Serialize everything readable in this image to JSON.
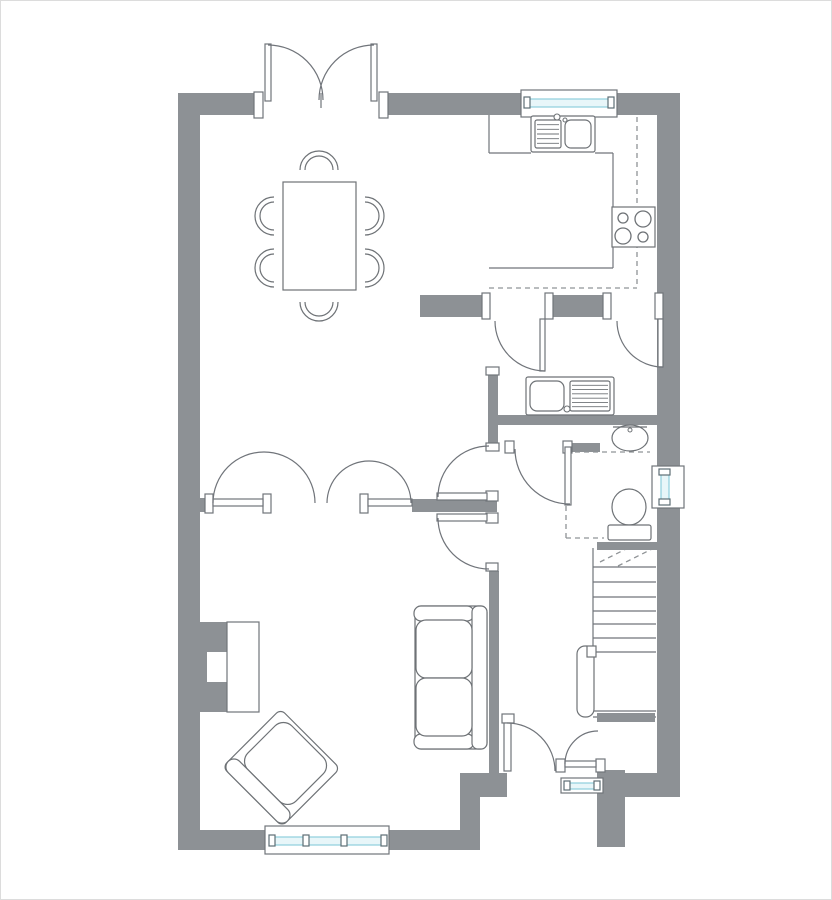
{
  "canvas": {
    "width": 832,
    "height": 900,
    "background": "#ffffff",
    "frame_color": "#dcdcdc"
  },
  "palette": {
    "wall": "#8d9195",
    "line": "#70747a",
    "furniture_line": "#6e7276",
    "dash": "#8f9396",
    "glass_stroke": "#8ecfdd",
    "glass_fill": "#e8f6f9",
    "tick": "#5d6d74",
    "white": "#ffffff"
  },
  "plan": {
    "walls": [
      [
        178,
        93,
        84,
        22
      ],
      [
        388,
        93,
        137,
        22
      ],
      [
        613,
        93,
        67,
        22
      ],
      [
        178,
        93,
        22,
        757
      ],
      [
        178,
        830,
        90,
        20
      ],
      [
        387,
        830,
        93,
        20
      ],
      [
        657,
        115,
        23,
        351
      ],
      [
        657,
        508,
        23,
        289
      ],
      [
        420,
        295,
        62,
        22
      ],
      [
        553,
        295,
        50,
        22
      ],
      [
        663,
        295,
        17,
        22
      ],
      [
        488,
        375,
        10,
        68
      ],
      [
        498,
        415,
        159,
        10
      ],
      [
        572,
        443,
        28,
        9
      ],
      [
        597,
        542,
        60,
        8
      ],
      [
        597,
        713,
        58,
        9
      ],
      [
        597,
        770,
        28,
        77
      ],
      [
        625,
        773,
        55,
        24
      ],
      [
        460,
        773,
        47,
        24
      ],
      [
        460,
        797,
        20,
        33
      ],
      [
        489,
        571,
        10,
        202
      ],
      [
        200,
        498,
        6,
        14
      ],
      [
        412,
        499,
        85,
        13
      ],
      [
        200,
        622,
        28,
        90
      ]
    ],
    "door_frames": [
      [
        254,
        92,
        9,
        26
      ],
      [
        379,
        92,
        9,
        26
      ],
      [
        482,
        293,
        8,
        26
      ],
      [
        545,
        293,
        8,
        26
      ],
      [
        603,
        293,
        8,
        26
      ],
      [
        655,
        293,
        8,
        26
      ],
      [
        486,
        367,
        13,
        8
      ],
      [
        486,
        443,
        13,
        8
      ],
      [
        486,
        491,
        12,
        10
      ],
      [
        486,
        513,
        12,
        10
      ],
      [
        486,
        563,
        12,
        8
      ],
      [
        505,
        441,
        9,
        12
      ],
      [
        563,
        441,
        9,
        12
      ],
      [
        502,
        714,
        12,
        9
      ],
      [
        556,
        759,
        9,
        13
      ],
      [
        596,
        759,
        9,
        13
      ],
      [
        205,
        494,
        8,
        19
      ],
      [
        263,
        494,
        8,
        19
      ],
      [
        360,
        494,
        8,
        19
      ]
    ],
    "door_leaves": [
      [
        265,
        44,
        6,
        57
      ],
      [
        371,
        44,
        6,
        57
      ],
      [
        213,
        499,
        50,
        7
      ],
      [
        368,
        499,
        44,
        7
      ],
      [
        437,
        493,
        50,
        7
      ],
      [
        437,
        514,
        50,
        7
      ],
      [
        540,
        319,
        5,
        52
      ],
      [
        658,
        319,
        5,
        48
      ],
      [
        565,
        447,
        6,
        58
      ],
      [
        504,
        723,
        7,
        48
      ],
      [
        565,
        761,
        31,
        6
      ]
    ],
    "door_arcs": [
      [
        268,
        100,
        55,
        270,
        360
      ],
      [
        374,
        100,
        55,
        180,
        270
      ],
      [
        264,
        503,
        51,
        180,
        360
      ],
      [
        369,
        503,
        42,
        180,
        360
      ],
      [
        489,
        497,
        51,
        180,
        270
      ],
      [
        489,
        518,
        51,
        90,
        180
      ],
      [
        545,
        321,
        50,
        90,
        180
      ],
      [
        663,
        321,
        46,
        90,
        180
      ],
      [
        570,
        449,
        55,
        90,
        180
      ],
      [
        507,
        771,
        48,
        270,
        360
      ],
      [
        598,
        764,
        33,
        180,
        270
      ]
    ],
    "windows": [
      {
        "box": [
          521,
          90,
          96,
          27
        ],
        "glass": [
          527,
          99,
          84,
          8
        ],
        "ticks": [
          [
            524,
            97,
            6,
            11
          ],
          [
            608,
            97,
            6,
            11
          ]
        ]
      },
      {
        "box": [
          265,
          826,
          124,
          28
        ],
        "glass": [
          271,
          837,
          112,
          8
        ],
        "ticks": [
          [
            269,
            835,
            6,
            11
          ],
          [
            303,
            835,
            6,
            11
          ],
          [
            341,
            835,
            6,
            11
          ],
          [
            381,
            835,
            6,
            11
          ]
        ]
      },
      {
        "box": [
          652,
          466,
          32,
          42
        ],
        "glass": [
          661,
          472,
          8,
          30
        ],
        "ticks": [
          [
            659,
            469,
            11,
            6
          ],
          [
            659,
            499,
            11,
            6
          ]
        ]
      },
      {
        "box": [
          561,
          778,
          42,
          15
        ],
        "glass": [
          567,
          783,
          30,
          6
        ],
        "ticks": [
          [
            564,
            781,
            6,
            9
          ],
          [
            594,
            781,
            6,
            9
          ]
        ]
      }
    ],
    "counter_lines": [
      [
        489,
        115,
        489,
        153
      ],
      [
        489,
        153,
        531,
        153
      ],
      [
        595,
        153,
        613,
        153
      ],
      [
        613,
        153,
        613,
        207
      ],
      [
        613,
        247,
        613,
        268
      ],
      [
        489,
        268,
        613,
        268
      ],
      [
        321,
        93,
        321,
        108
      ]
    ],
    "dashed_lines": [
      [
        637,
        117,
        637,
        288
      ],
      [
        489,
        288,
        637,
        288
      ],
      [
        566,
        452,
        650,
        452
      ],
      [
        566,
        452,
        566,
        538
      ],
      [
        566,
        538,
        604,
        538
      ],
      [
        600,
        562,
        632,
        546
      ],
      [
        618,
        566,
        652,
        549
      ]
    ],
    "stairs": {
      "side_edge": [
        593,
        548,
        593,
        712
      ],
      "tread_x": [
        593,
        656
      ],
      "tread_y": [
        567,
        582,
        597,
        611,
        624,
        638,
        652
      ],
      "bottom_lines": [
        [
          593,
          711,
          656,
          711
        ],
        [
          593,
          717,
          656,
          717
        ]
      ],
      "handrail": [
        577,
        646,
        17,
        71
      ],
      "newel": [
        587,
        646,
        9,
        11
      ]
    },
    "fireplace": {
      "hearth": [
        227,
        622,
        32,
        90
      ],
      "notch": [
        207,
        652,
        22,
        30
      ]
    },
    "kitchen_sink": {
      "unit": [
        531,
        116,
        64,
        36
      ],
      "drainer": [
        535,
        120,
        26,
        28
      ],
      "bowl": [
        565,
        120,
        26,
        28
      ],
      "tap": [
        557,
        117
      ]
    },
    "hob": {
      "box": [
        612,
        207,
        43,
        40
      ],
      "burners": [
        [
          623,
          218,
          5
        ],
        [
          643,
          219,
          8
        ],
        [
          623,
          236,
          8
        ],
        [
          643,
          237,
          5
        ]
      ]
    },
    "utility_sink": {
      "unit": [
        526,
        377,
        88,
        38
      ],
      "bowl": [
        530,
        381,
        34,
        30
      ],
      "drainer": [
        570,
        381,
        40,
        30
      ],
      "tap": [
        567,
        409
      ]
    },
    "basin": {
      "cx": 630,
      "cy": 438,
      "rx": 18,
      "ry": 13,
      "top_line": [
        613,
        427,
        647,
        427
      ],
      "tap": [
        630,
        430
      ]
    },
    "toilet": {
      "bowl_cx": 629,
      "bowl_cy": 507,
      "bowl_rx": 17,
      "bowl_ry": 18,
      "cistern": [
        608,
        525,
        43,
        15
      ]
    },
    "dining_table": [
      283,
      182,
      73,
      108
    ],
    "dining_chairs": {
      "r_outer": 19,
      "r_inner": 14,
      "seats": [
        [
          319,
          170,
          0
        ],
        [
          319,
          302,
          180
        ],
        [
          274,
          216,
          -90
        ],
        [
          274,
          268,
          -90
        ],
        [
          365,
          216,
          90
        ],
        [
          365,
          268,
          90
        ]
      ]
    },
    "sofa": {
      "outer": [
        415,
        606,
        72,
        143
      ],
      "arm_top": [
        414,
        606,
        60,
        15
      ],
      "arm_bottom": [
        414,
        734,
        60,
        15
      ],
      "back": [
        472,
        606,
        15,
        143
      ],
      "cushions": [
        [
          416,
          620,
          56,
          58
        ],
        [
          416,
          678,
          56,
          58
        ]
      ]
    },
    "armchair": {
      "cx": 282,
      "cy": 767,
      "rotation": 45,
      "outer": [
        -42,
        -40,
        84,
        82
      ],
      "cushion": [
        -34,
        -36,
        68,
        62
      ],
      "back": [
        -42,
        26,
        84,
        16
      ]
    }
  }
}
